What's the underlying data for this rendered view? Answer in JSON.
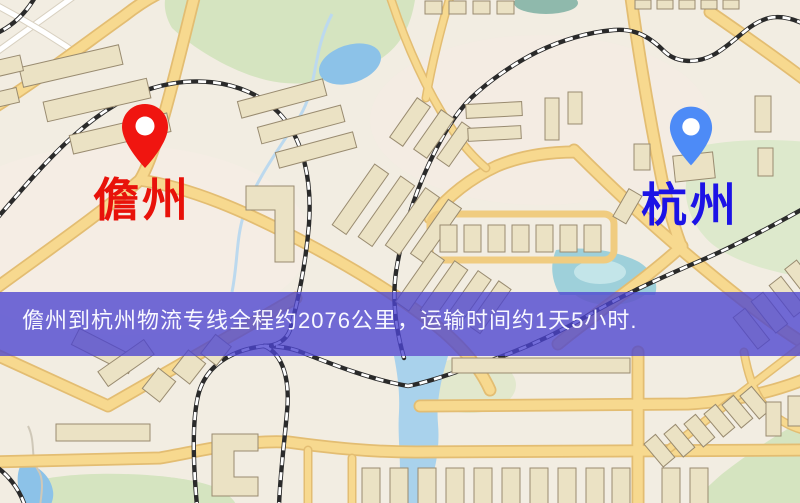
{
  "map": {
    "origin": {
      "name": "儋州",
      "label_color": "#e8120a",
      "pin_color": "#f01510"
    },
    "destination": {
      "name": "杭州",
      "label_color": "#1c13e6",
      "pin_color": "#4d8bf7"
    }
  },
  "banner": {
    "text": "儋州到杭州物流专线全程约2076公里，运输时间约1天5小时.",
    "bg_color": "#4b44cf",
    "text_color": "#f8f8ff"
  },
  "route": {
    "origin": "儋州",
    "destination": "杭州",
    "distance_km": "2076",
    "duration": "1天5小时"
  },
  "map_palette": {
    "background": "#f2ede2",
    "road_fill": "#f7d98f",
    "road_casing": "#e3bd72",
    "park": "#d5e4c0",
    "water": "#8cc2e8",
    "building": "#ebe2c4",
    "railway": "#2a2a2a"
  }
}
